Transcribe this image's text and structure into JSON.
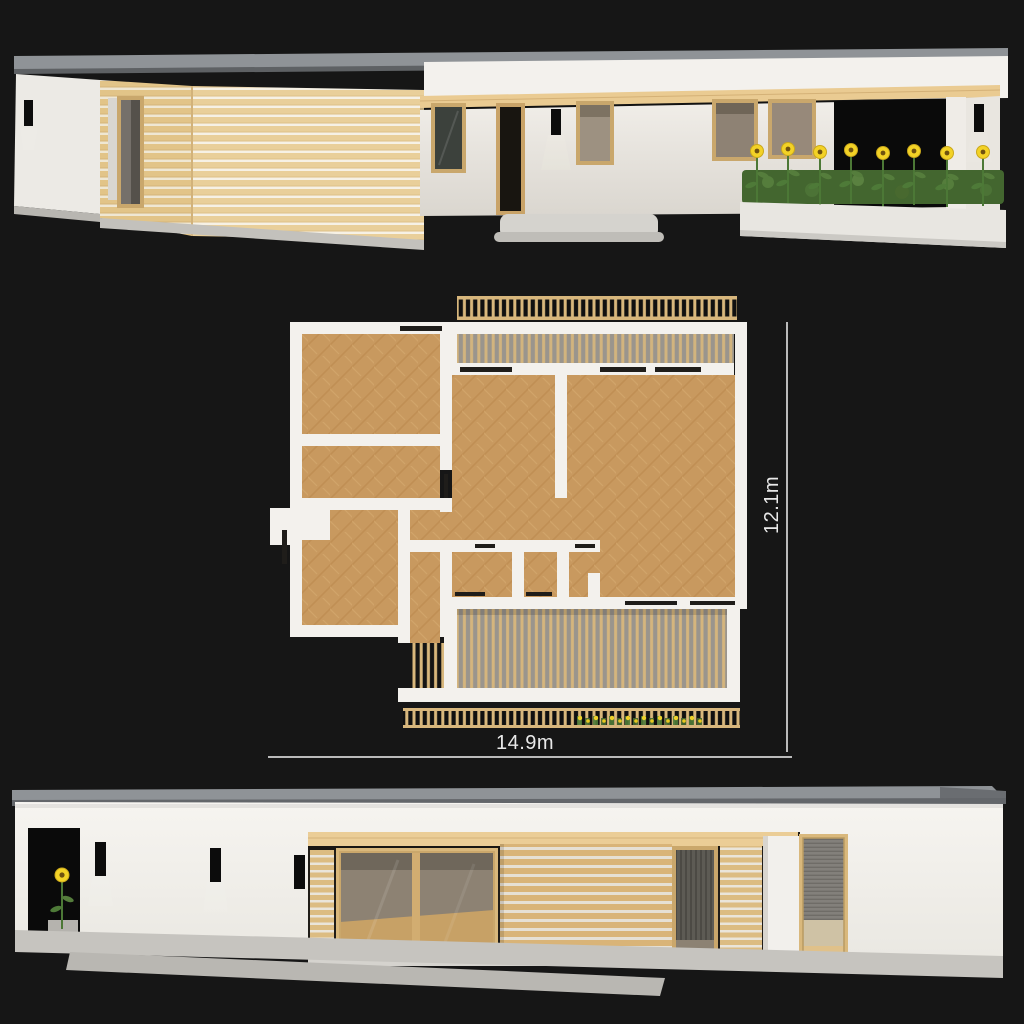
{
  "scene": {
    "background": "#161616"
  },
  "floor_plan": {
    "width_label": "14.9m",
    "depth_label": "12.1m"
  },
  "colors": {
    "wall_white": "#f3f1ed",
    "wood_cladding": "#e9cf9a",
    "wood_slat": "#d8b77c",
    "wood_frame": "#c9a76c",
    "parquet": "#c8995f",
    "roof_gray": "#8f9397",
    "concrete": "#c6c4bf",
    "deck_gray": "#9a958d",
    "opening_black": "#0a0a0a",
    "sunflower_yellow": "#f3d226",
    "leaf_green": "#4e7a38",
    "dimension_line": "#c9c9c9"
  }
}
